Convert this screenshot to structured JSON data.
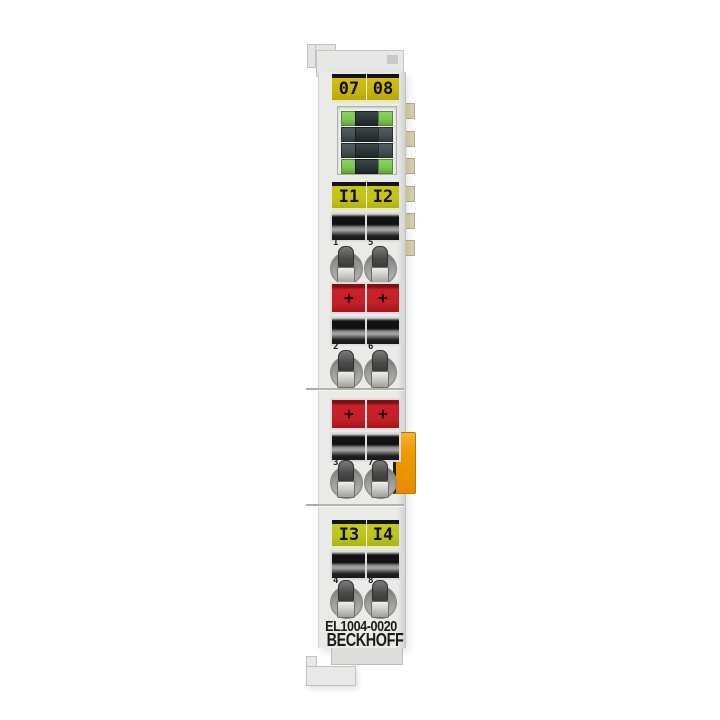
{
  "product": {
    "model_label": "EL1004-0020",
    "brand_label": "BECKHOFF"
  },
  "designation_labels": {
    "top": [
      "07",
      "08"
    ],
    "mid": [
      "I1",
      "I2"
    ],
    "low": [
      "I3",
      "I4"
    ]
  },
  "terminal_point_numbers": {
    "row1": [
      "1",
      "5"
    ],
    "row2": [
      "2",
      "6"
    ],
    "row3": [
      "3",
      "7"
    ],
    "row4": [
      "4",
      "8"
    ]
  },
  "power_contact_marks": {
    "row1": [
      "+",
      "+"
    ],
    "row2": [
      "+",
      "+"
    ]
  },
  "led_panel": {
    "rows": [
      {
        "type": "green-dark-green"
      },
      {
        "type": "dark-dark-dark"
      },
      {
        "type": "dark-dark-dark"
      },
      {
        "type": "green-dark-green"
      }
    ]
  },
  "colors": {
    "background": "#ffffff",
    "housing_gray": "#eaeae8",
    "label_yellow_gold": "#c7b40c",
    "label_yellow_green": "#c2c414",
    "led_green": "#7fc653",
    "led_dark": "#2a3436",
    "power_contact_red": "#c32028",
    "release_tab_orange": "#f09a00",
    "ebus_tab_beige": "#d9d0ae",
    "print_color": "#1e1a1a"
  }
}
